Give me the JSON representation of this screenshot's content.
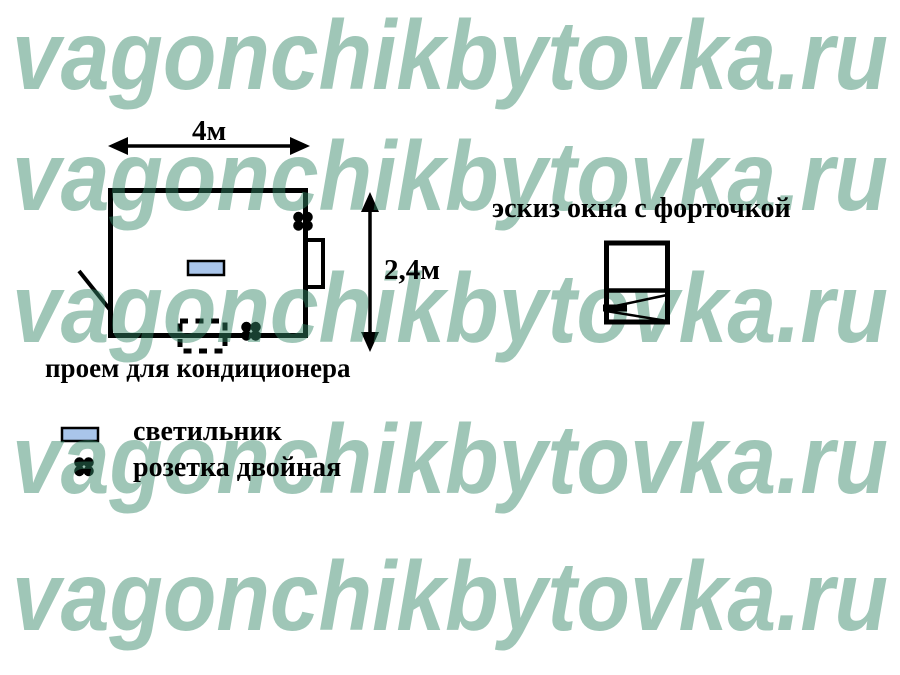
{
  "watermark": {
    "text": "vagonchikbytovka.ru",
    "rows": 5,
    "color": "#338566",
    "opacity": 0.47
  },
  "floor_plan": {
    "width_label": "4м",
    "height_label": "2,4м",
    "opening_label": "проем для кондиционера"
  },
  "window_sketch": {
    "title": "эскиз окна с форточкой"
  },
  "legend": {
    "items": [
      {
        "symbol": "light-fixture",
        "label": "светильник",
        "color": "#a9c5ea"
      },
      {
        "symbol": "double-socket",
        "label": "розетка двойная",
        "color": "#000000"
      }
    ]
  },
  "colors": {
    "background": "#ffffff",
    "line": "#000000",
    "watermark_green": "#338566",
    "light_fixture_blue": "#a9c5ea"
  }
}
